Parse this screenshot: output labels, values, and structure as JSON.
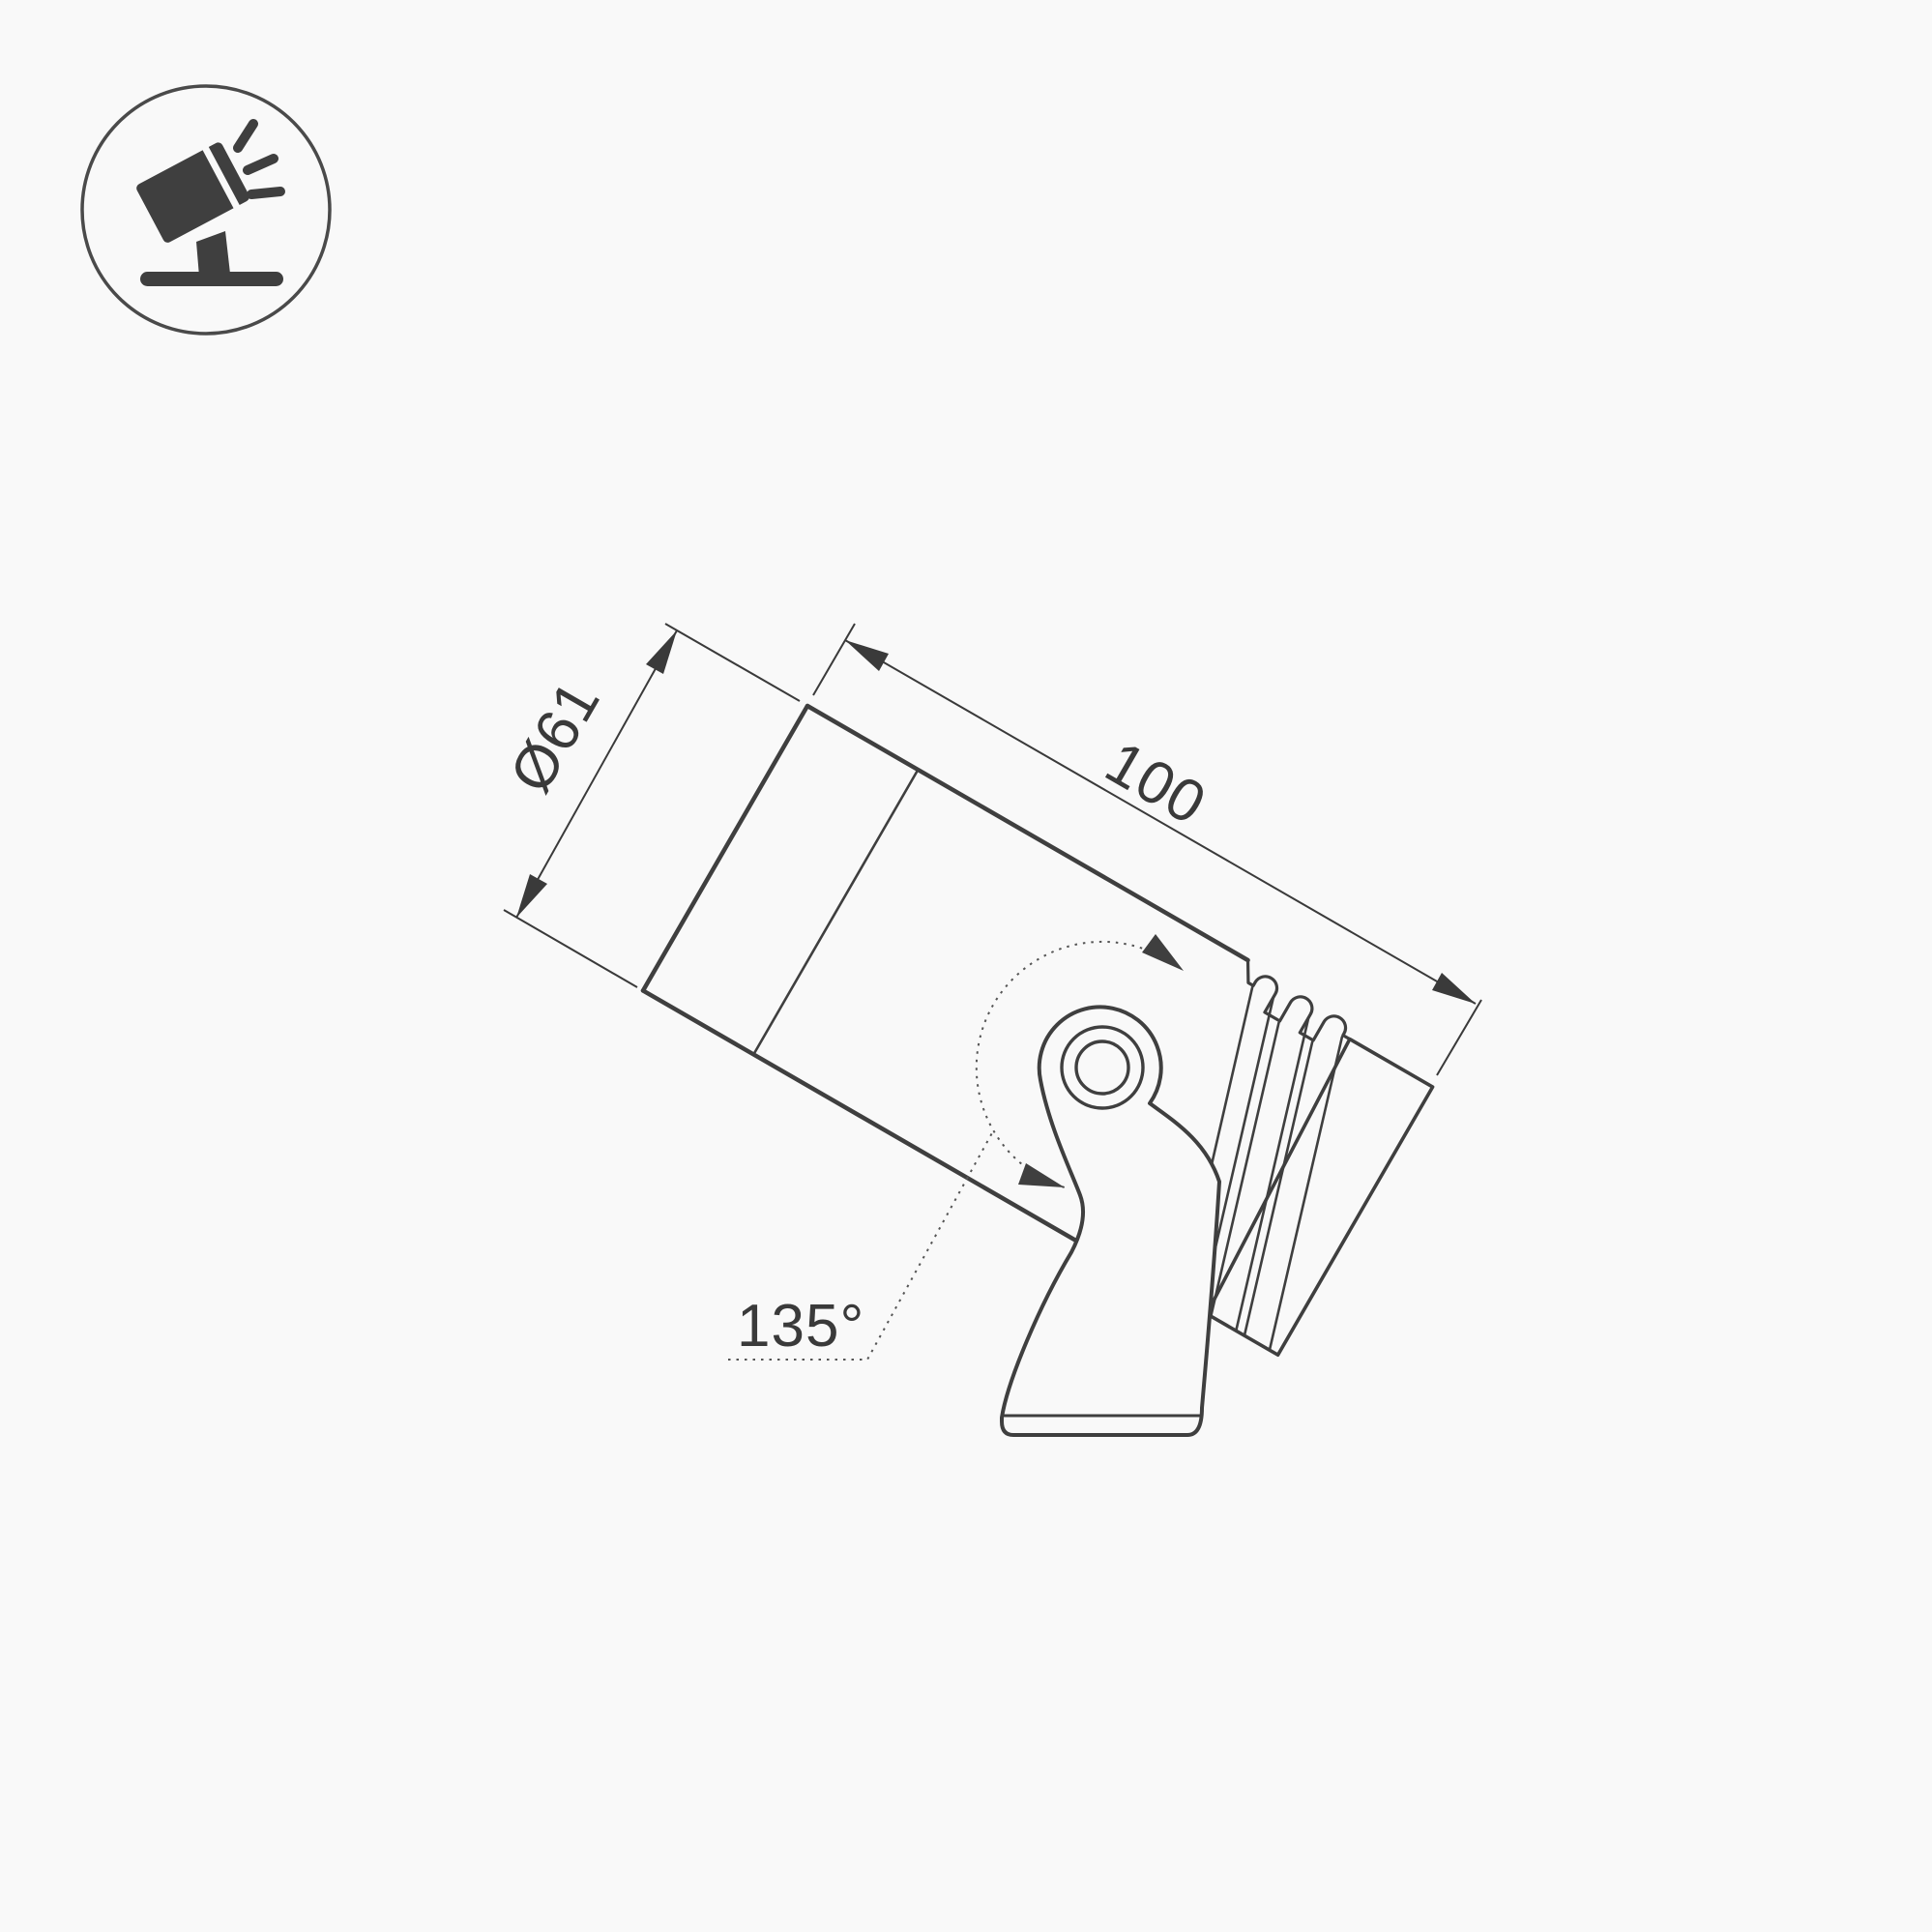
{
  "page": {
    "background": "#f9f9f9",
    "line_color": "#3f3f3f",
    "dim_line_color": "#3a3a3a",
    "description": "Technical dimension drawing of a tilted LED landscape spotlight on a swivel mounting bracket"
  },
  "icon": {
    "name": "tilted-spotlight-pictogram",
    "shape": "circle-outline with dark tilted lamp head, light rays, stem and ground bar"
  },
  "drawing": {
    "labels": {
      "diameter": "Ø61",
      "length": "100",
      "swivel_angle": "135°"
    },
    "features": [
      "front-lens-face",
      "bezel-ring-line",
      "main-barrel",
      "heatsink-fins",
      "rear-cap",
      "swivel-bracket-with-pivot",
      "base-plate",
      "rotation-arc-double-arrow"
    ]
  }
}
